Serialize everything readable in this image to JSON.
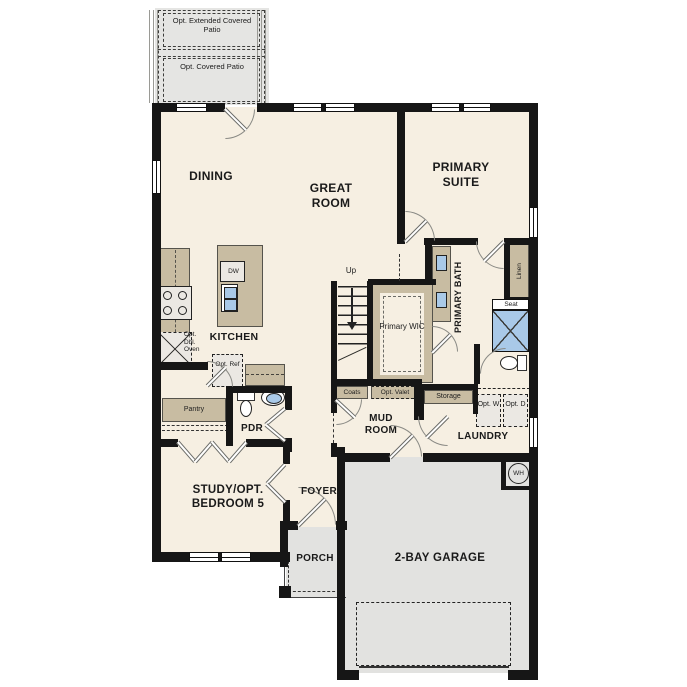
{
  "patio": {
    "extended": "Opt. Extended Covered Patio",
    "covered": "Opt. Covered Patio"
  },
  "rooms": {
    "dining": "DINING",
    "great_room": "GREAT ROOM",
    "primary_suite": "PRIMARY SUITE",
    "kitchen": "KITCHEN",
    "pdr": "PDR",
    "primary_wic": "Primary WIC",
    "primary_bath": "PRIMARY BATH",
    "mud_room": "MUD ROOM",
    "laundry": "LAUNDRY",
    "study": "STUDY/OPT. BEDROOM 5",
    "foyer": "FOYER",
    "porch": "PORCH",
    "garage": "2-BAY GARAGE"
  },
  "features": {
    "up": "Up",
    "dw": "DW",
    "opt_dbl_oven": "Opt. Dbl. Oven",
    "opt_ref": "Opt. Ref",
    "pantry": "Pantry",
    "coats": "Coats",
    "opt_valet": "Opt. Valet",
    "storage": "Storage",
    "opt_washer": "Opt. W",
    "opt_dryer": "Opt. D",
    "linen": "Linen",
    "seat": "Seat",
    "water_heater": "WH"
  },
  "colors": {
    "wall": "#161616",
    "floor": "#f6efe2",
    "cabinetry": "#c8bca2",
    "concrete": "#e5e5e3",
    "fixture_blue": "#a9c9e8",
    "fixture_gray": "#ebe8e3"
  }
}
